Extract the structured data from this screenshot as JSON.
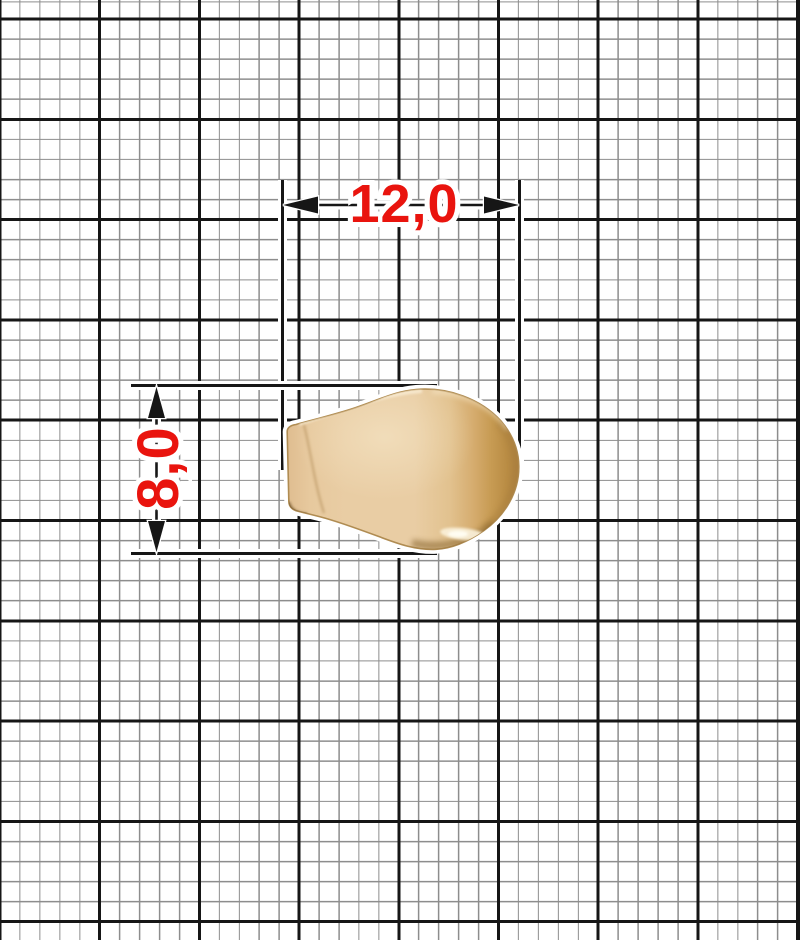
{
  "page": {
    "description": "Technical dimension drawing of a metal cord-end tip (zipper pull tip) on millimeter graph paper"
  },
  "drawing": {
    "object": "cord-end-tip",
    "dimensions": {
      "width_label": "12,0",
      "height_label": "8,0"
    },
    "colors": {
      "dimension_text_red": "#e9140e",
      "dimension_line_black": "#161616",
      "grid_major": "#161616",
      "grid_thin": "#8d8d8d",
      "object_base_gold": "#e9cda4",
      "object_dark_gold": "#ad8040",
      "object_highlight": "#f9efd7",
      "paper": "#ffffff"
    }
  }
}
